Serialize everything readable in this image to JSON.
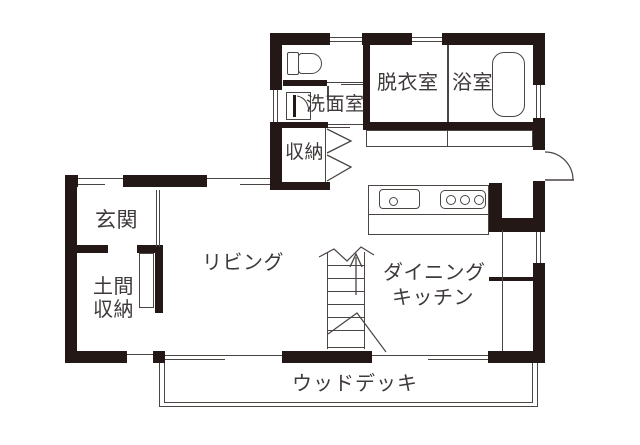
{
  "title": "1F floor plan",
  "colors": {
    "wall": "#231815",
    "line": "#4a4543",
    "text": "#3e3a39",
    "background": "#ffffff"
  },
  "rooms": {
    "entrance": {
      "label": "玄関"
    },
    "doma_storage": {
      "line1": "土間",
      "line2": "収納"
    },
    "living": {
      "label": "リビング"
    },
    "storage": {
      "label": "収納"
    },
    "washroom": {
      "label": "洗面室"
    },
    "dressing_room": {
      "label": "脱衣室"
    },
    "bathroom": {
      "label": "浴室"
    },
    "dining_kitchen": {
      "line1": "ダイニング",
      "line2": "キッチン"
    },
    "wood_deck": {
      "label": "ウッドデッキ"
    }
  },
  "icons": {
    "toilet": "toilet-icon",
    "bathtub": "bathtub-icon",
    "kitchen_sink": "kitchen-sink-icon",
    "stove": "stove-icon",
    "stairs": "stairs-up-icon",
    "bifold_door": "bifold-door-icon",
    "washroom_door": "hinged-door-icon",
    "back_door": "swing-door-icon",
    "sliding_windows": "sliding-window-icon"
  }
}
